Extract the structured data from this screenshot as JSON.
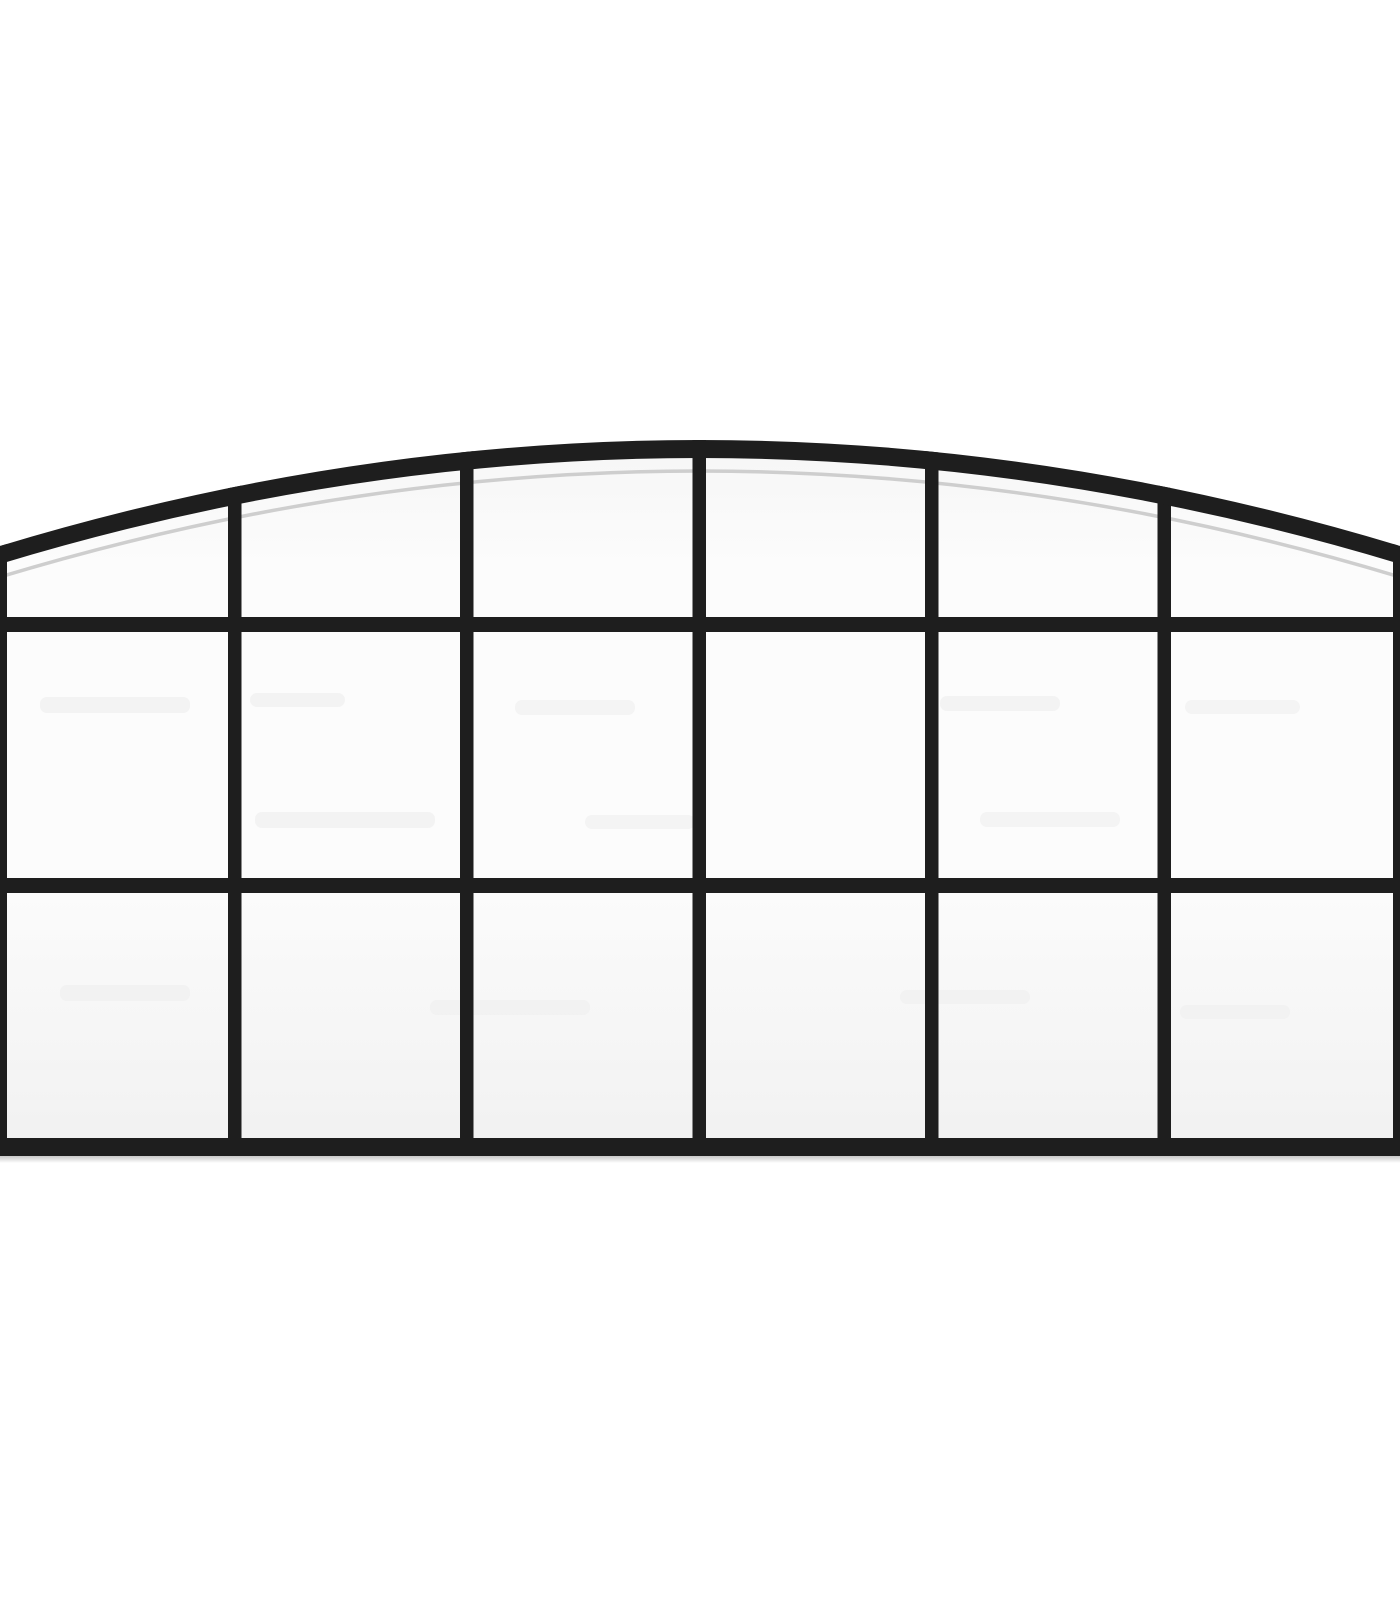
{
  "image": {
    "description": "Product photo of a black metal arch-top wall mirror / window-pane grille, front view, centered on a plain white background",
    "style": "product-photo",
    "background_color": "#ffffff"
  },
  "window": {
    "subject": "arched window mirror",
    "columns": 6,
    "rows": 3,
    "pane_count": 18,
    "colors": {
      "frame": "#1e1e1e",
      "frame_intersection": "#262626",
      "glass_top": "#f6f6f6",
      "glass_light": "#fcfcfc",
      "glass_bottom": "#f1f1f1",
      "glass_edge_highlight": "#c9c9c9",
      "bottom_shadow": "#9a9a9a",
      "smudge": "#e9e9e9",
      "background": "#ffffff"
    },
    "geometry": {
      "canvas": {
        "width": 1400,
        "height": 1600
      },
      "outer_arch": {
        "x0": 0,
        "y0": 546,
        "cx": 700,
        "cy": 334,
        "x1": 1400,
        "y1": 546
      },
      "inner_arch": {
        "x0": 0,
        "y0": 564,
        "cx": 700,
        "cy": 352,
        "x1": 1400,
        "y1": 564
      },
      "highlight_arch": {
        "x0": 0,
        "y0": 577,
        "cx": 700,
        "cy": 365,
        "x1": 1400,
        "y1": 577
      },
      "highlight_width": 3.5,
      "body_bottom": 1156,
      "stile_width": 7,
      "mullions": {
        "width": 13.5,
        "x": [
          228,
          460,
          692.5,
          925,
          1157.5
        ]
      },
      "rails": [
        {
          "y": 617,
          "h": 15
        },
        {
          "y": 878,
          "h": 15
        }
      ],
      "bottom_rail": {
        "y": 1138,
        "h": 18
      },
      "bottom_shadow": {
        "y": 1156,
        "h": 7
      }
    },
    "smudges": [
      {
        "x": 40,
        "y": 697,
        "w": 150,
        "h": 16,
        "o": 0.5
      },
      {
        "x": 250,
        "y": 693,
        "w": 95,
        "h": 14,
        "o": 0.45
      },
      {
        "x": 515,
        "y": 700,
        "w": 120,
        "h": 15,
        "o": 0.4
      },
      {
        "x": 940,
        "y": 696,
        "w": 120,
        "h": 15,
        "o": 0.45
      },
      {
        "x": 1185,
        "y": 700,
        "w": 115,
        "h": 14,
        "o": 0.4
      },
      {
        "x": 255,
        "y": 812,
        "w": 180,
        "h": 16,
        "o": 0.45
      },
      {
        "x": 585,
        "y": 815,
        "w": 110,
        "h": 14,
        "o": 0.4
      },
      {
        "x": 980,
        "y": 812,
        "w": 140,
        "h": 15,
        "o": 0.4
      },
      {
        "x": 60,
        "y": 985,
        "w": 130,
        "h": 16,
        "o": 0.35
      },
      {
        "x": 430,
        "y": 1000,
        "w": 160,
        "h": 15,
        "o": 0.35
      },
      {
        "x": 900,
        "y": 990,
        "w": 130,
        "h": 14,
        "o": 0.35
      },
      {
        "x": 1180,
        "y": 1005,
        "w": 110,
        "h": 14,
        "o": 0.3
      }
    ]
  }
}
